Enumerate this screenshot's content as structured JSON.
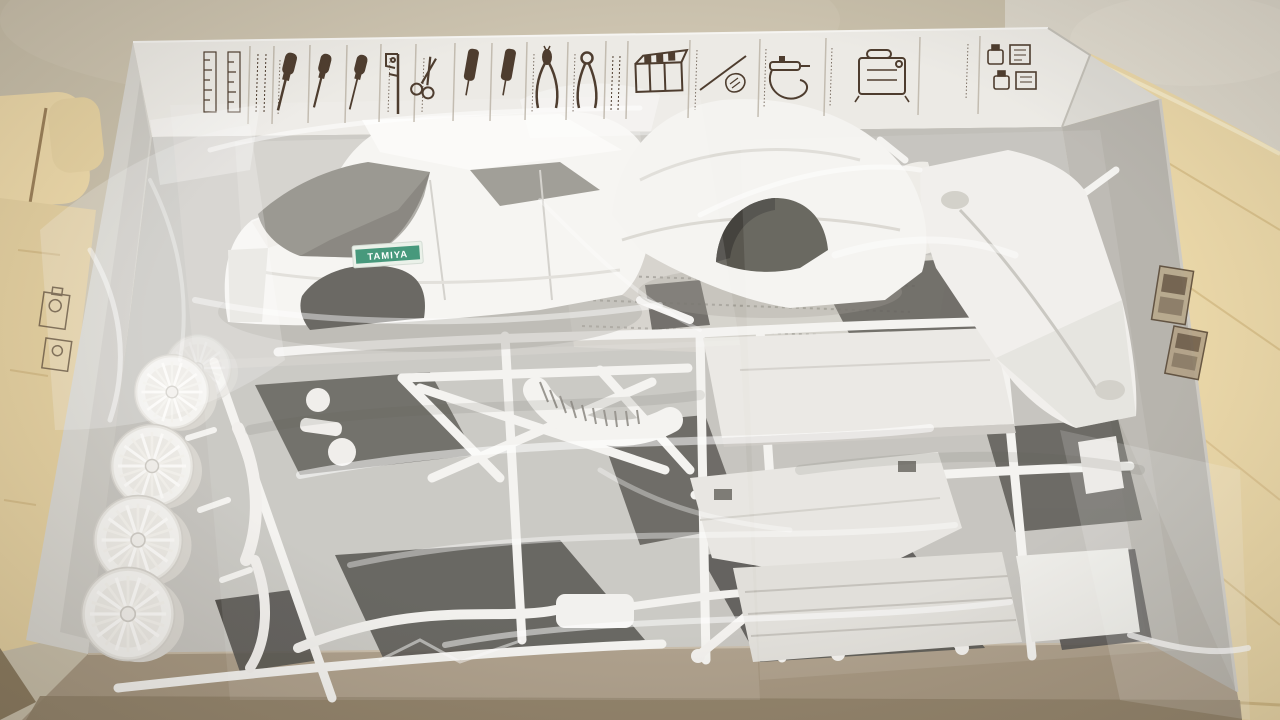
{
  "scene": {
    "type": "photograph",
    "subject": "Opened plastic model car kit box with white styrene sprues sealed in clear bags",
    "setting": "box resting on a light wooden table against a beige carpeted floor"
  },
  "box": {
    "inner_lid_print": "row of sepia hobby-tool illustrations",
    "lid_tools": [
      "scale-ruler",
      "ruled-label",
      "screwdriver-large",
      "screwdriver-medium",
      "screwdriver-small",
      "caliper",
      "scissors",
      "modeling-file",
      "modeling-file-2",
      "needle-nose-pliers",
      "side-cutter",
      "label-panel",
      "paint-station",
      "hand-with-knife",
      "spray-work-airbrush",
      "compressor",
      "paint-bottle-set"
    ],
    "side_wall_prints": [
      "paint-bottle-print",
      "paint-jar-print",
      "metallic-label-print",
      "metallic-label-print-2"
    ]
  },
  "contents": {
    "body_shell": {
      "sticker_text": "TAMIYA",
      "sticker_color": "#2e8b6a"
    },
    "parts": [
      "car-body-shell",
      "front-body-clip",
      "chassis-tub",
      "wheel-sprue-four-mesh-wheels",
      "roll-cage-sprue",
      "curved-duct-part",
      "exhaust-with-muffler",
      "suspension-arms",
      "interior-floor-panel",
      "parcel-shelf-panel",
      "rear-floor-pan",
      "flat-plate",
      "rear-axle-arms",
      "dark-sprues-underneath",
      "instruction-sheets",
      "clear-part-bags"
    ]
  },
  "colors": {
    "wall_beige": "#c8bfaa",
    "carpet": "#dad5c9",
    "wood": "#ead7a8",
    "wood_grain": "#d8c08b",
    "lid_white": "#eceae5",
    "box_wall_grey": "#b7b4ad",
    "box_edge_taupe": "#a69781",
    "interior_grey": "#c6c4bf",
    "sprue_white": "#f3f2ef",
    "dark_parts": "#514f49",
    "print_sepia": "#4e3d2f",
    "sticker_green": "#2e8b6a"
  }
}
